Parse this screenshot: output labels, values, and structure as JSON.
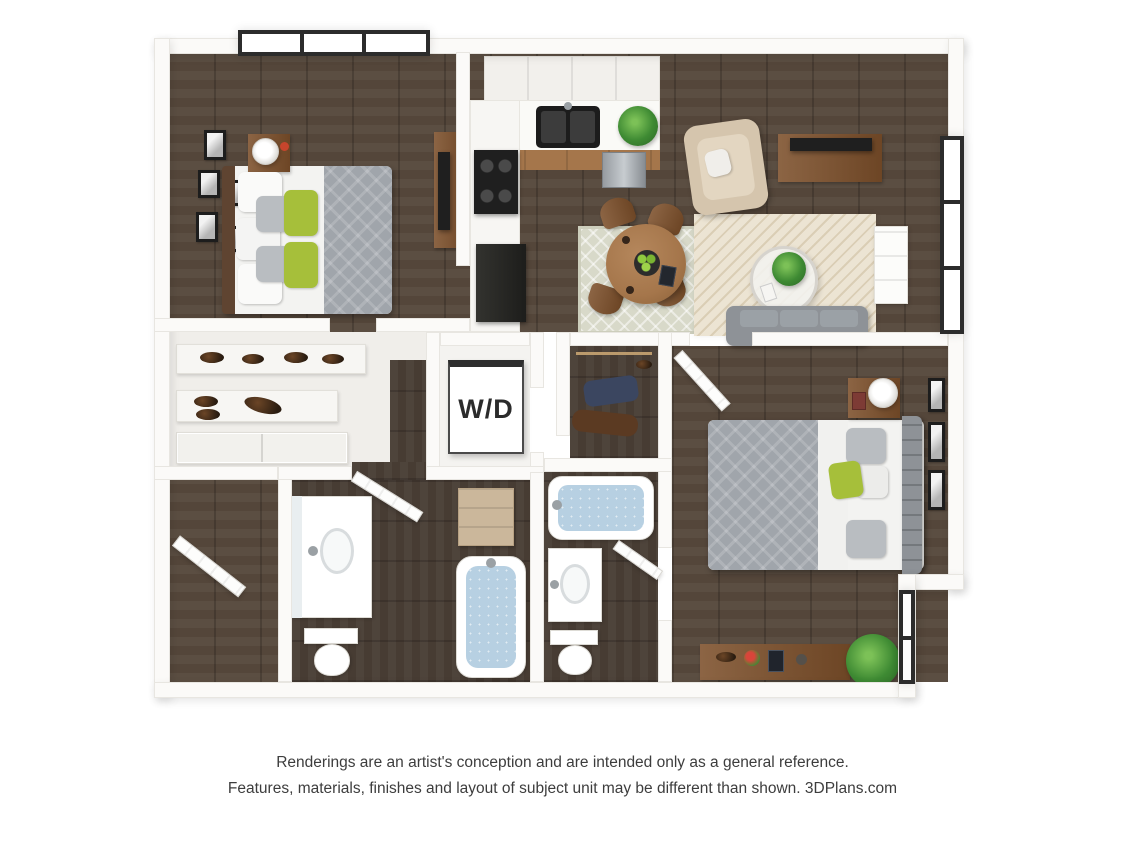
{
  "plan": {
    "washer_dryer_label": "W/D",
    "rooms": {
      "bedroom_1": [
        "window",
        "picture-frames",
        "nightstand",
        "table-lamp",
        "queen-bed",
        "white-pillows",
        "gray-pillows",
        "green-accent-pillows",
        "gray-duvet",
        "dresser",
        "tv"
      ],
      "kitchen": [
        "upper-cabinets",
        "counter",
        "double-basin-sink",
        "dishwasher",
        "range",
        "refrigerator",
        "counter-plant"
      ],
      "dining_area": [
        "area-rug",
        "round-dining-table",
        "dining-chairs",
        "fruit-bowl",
        "tablet"
      ],
      "living_room": [
        "armchair",
        "throw-pillow",
        "media-console",
        "tv",
        "side-table",
        "area-rug",
        "round-coffee-table",
        "potted-plant",
        "sofa",
        "window"
      ],
      "walk_in_closet": [
        "shoe-shelves",
        "shoes",
        "sliding-doors"
      ],
      "laundry_closet": [
        "washer-dryer-unit"
      ],
      "clothes_closet": [
        "hanging-rod",
        "garments",
        "shoes"
      ],
      "bathroom_1": [
        "door",
        "vanity-sink",
        "mirror",
        "toilet",
        "bathtub",
        "storage-cabinet"
      ],
      "bathroom_2": [
        "bathtub",
        "vanity-sink",
        "toilet",
        "door"
      ],
      "bedroom_2": [
        "door",
        "queen-bed",
        "patterned-duvet",
        "green-accent-pillow",
        "tufted-headboard",
        "nightstand",
        "table-lamp",
        "picture-frames",
        "desk",
        "desk-accessories",
        "potted-plant",
        "window"
      ],
      "entry": [
        "front-door"
      ]
    }
  },
  "footer": {
    "line1": "Renderings are an artist's conception and are intended only as a general reference.",
    "line2": "Features, materials, finishes and layout of subject unit may be different than shown. 3DPlans.com"
  },
  "colors": {
    "wall": "#fbfaf8",
    "wall_edge": "#e8e6e1",
    "wood_floor": "#54463a",
    "wood_floor_dark": "#473c33",
    "window_frame": "#2c2c2c",
    "glass": "#ffffff",
    "porcelain": "#ffffff",
    "fixture_edge": "#dddbd5",
    "water": "#b7d0e2",
    "rug_living": "#ece4d3",
    "rug_dining": "#d8d9c9",
    "sofa_gray": "#8e9297",
    "cushion_gray": "#9ba1a6",
    "armchair_beige": "#d5c5ad",
    "wood_furniture": "#7c4f2a",
    "wood_light": "#a5764b",
    "wood_dark": "#5f4431",
    "appliance_black": "#1f1f1f",
    "stainless": "#aab0b5",
    "linen_white": "#f3f3f1",
    "duvet_gray": "#a0a5ab",
    "pillow_gray": "#b9bdc1",
    "accent_green": "#a6bf3a",
    "plant_green": "#3e8a33",
    "tan_cabinet": "#cbb79b",
    "navy_garment": "#3b4660",
    "brown_garment": "#5b3a22",
    "door_white": "#fdfdfc",
    "text_color": "#3d3d3d"
  }
}
